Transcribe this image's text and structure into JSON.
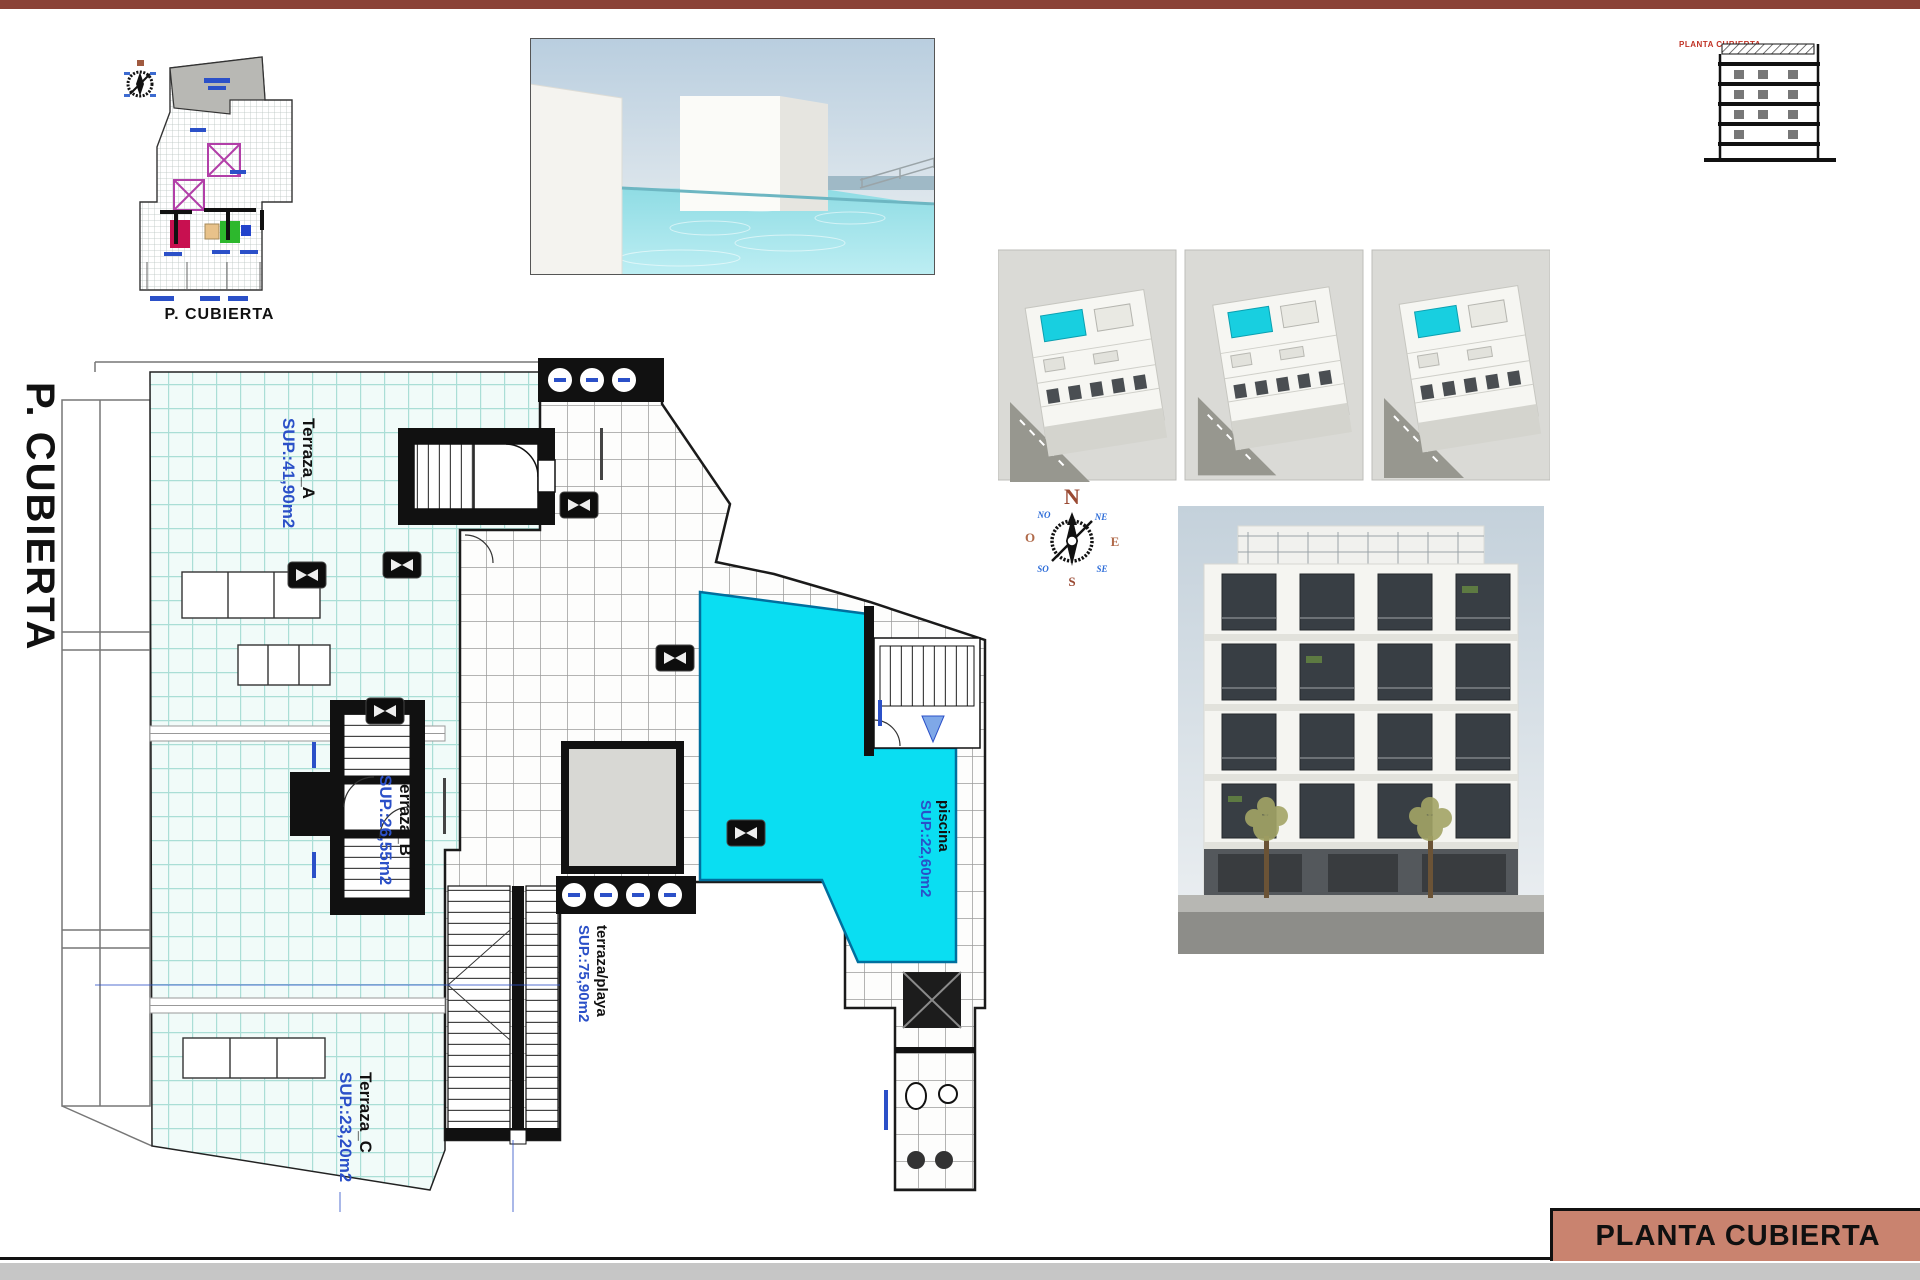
{
  "sheet": {
    "title": "PLANTA CUBIERTA",
    "side_label": "P. CUBIERTA",
    "site_plan_caption": "P. CUBIERTA",
    "section_caption": "PLANTA CUBIERTA"
  },
  "plan": {
    "rooms": [
      {
        "id": "terraza-a",
        "name": "Terraza_A",
        "area": "SUP.:41,90m2"
      },
      {
        "id": "terraza-b",
        "name": "Terraza_B",
        "area": "SUP.:26,55m2"
      },
      {
        "id": "terraza-c",
        "name": "Terraza_C",
        "area": "SUP.:23,20m2"
      },
      {
        "id": "terraza-playa",
        "name": "terraza/playa",
        "area": "SUP.:75,90m2"
      },
      {
        "id": "piscina",
        "name": "piscina",
        "area": "SUP.:22,60m2"
      }
    ]
  },
  "compass": {
    "n": "N",
    "ne": "NE",
    "e": "E",
    "se": "SE",
    "s": "S",
    "so": "SO",
    "o": "O",
    "no": "NO"
  },
  "colors": {
    "accent_salmon": "#c9836f",
    "top_bar_brown": "#8a4237",
    "pool_cyan": "#0adef2",
    "terrace_tile_line": "#aaded6",
    "label_blue": "#2b50c8"
  }
}
